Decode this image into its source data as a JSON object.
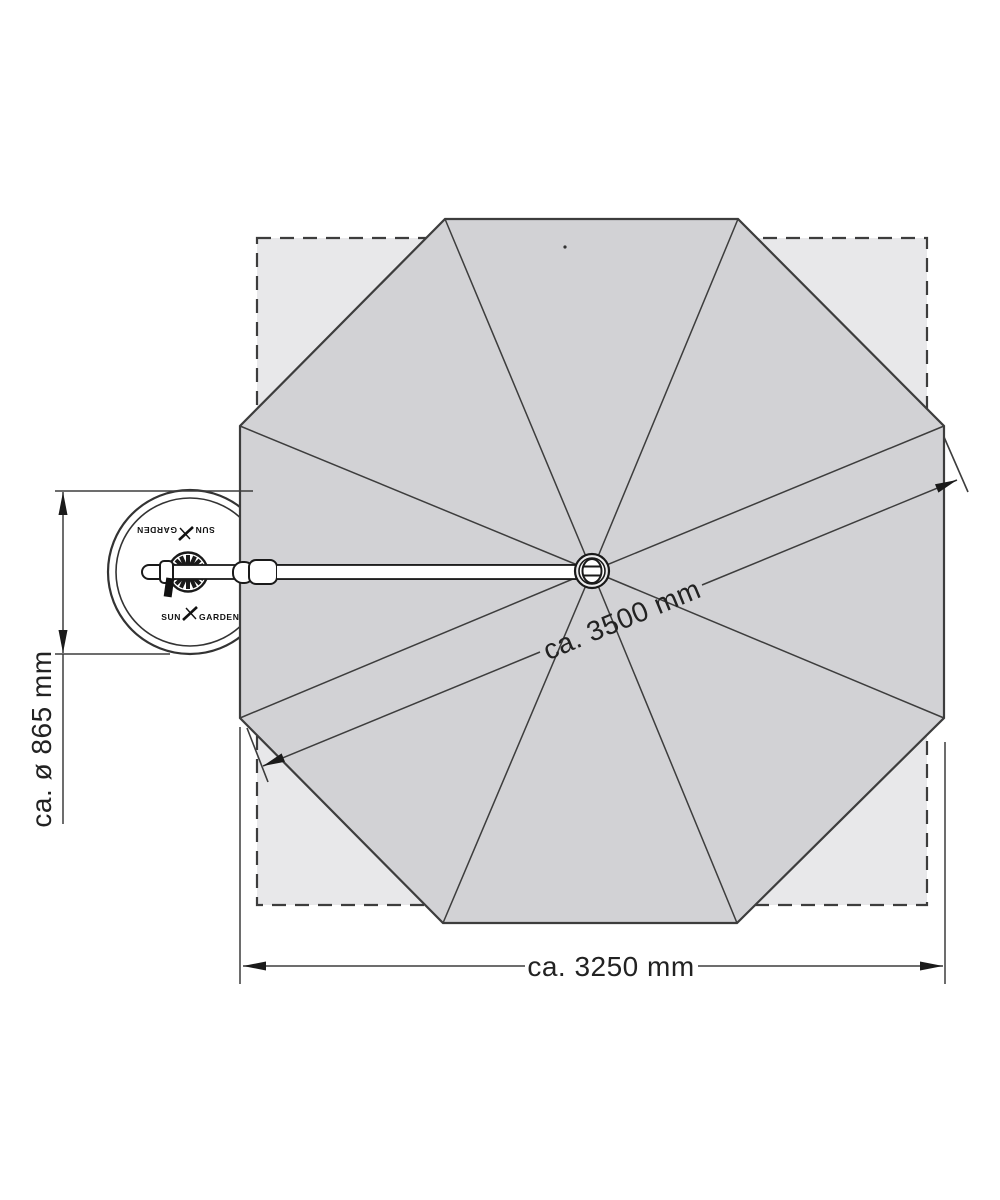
{
  "dimensions": {
    "diagonal": "ca. 3500 mm",
    "width": "ca. 3250 mm",
    "base": "ca. ø 865 mm"
  },
  "brand": {
    "sun": "SUN",
    "garden": "GARDEN"
  },
  "colors": {
    "canopy": "#d2d2d5",
    "coverage": "#e8e8ea",
    "line": "#3d3d3d",
    "text": "#222222",
    "background": "#ffffff"
  }
}
